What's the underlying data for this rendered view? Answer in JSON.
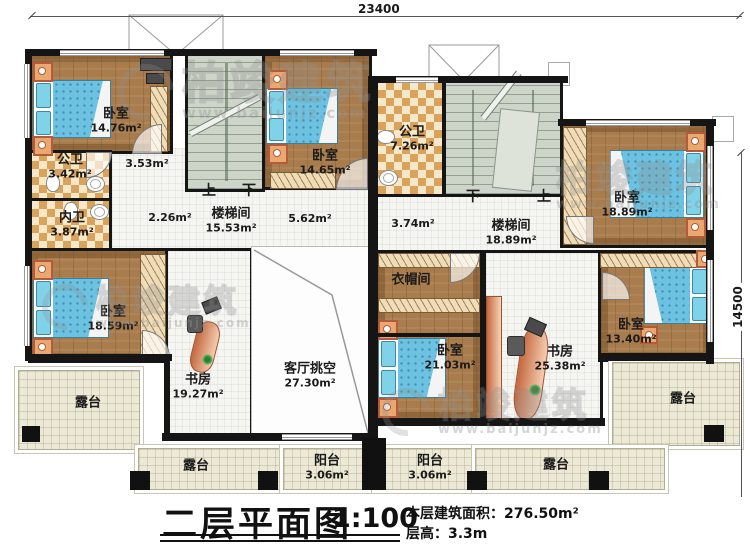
{
  "title": {
    "main": "二层平面图",
    "scale": "1:100",
    "area_label": "本层建筑面积：",
    "area_value": "276.50m²",
    "height_label": "层高：",
    "height_value": "3.3m"
  },
  "dimensions": {
    "width": "23400",
    "height": "14500"
  },
  "watermark": {
    "brand": "柏竣建筑",
    "url": "www.baijunjz.com"
  },
  "stairs": {
    "up": "上",
    "down": "下"
  },
  "colors": {
    "wall": "#151515",
    "wood_floor": "#a87c4c",
    "tile": "#d9a35c",
    "bed": "#6cc2e0",
    "stair": "#cdd5c9",
    "terrace": "#ece9d6"
  },
  "rooms": {
    "bedroom_tl": {
      "name": "卧室",
      "area": "14.76m²"
    },
    "bath_public_1": {
      "name": "公卫",
      "area": "3.42m²"
    },
    "bath_inner": {
      "name": "内卫",
      "area": "3.87m²"
    },
    "hall_353": {
      "area": "3.53m²"
    },
    "hall_226": {
      "area": "2.26m²"
    },
    "stair_left": {
      "name": "楼梯间",
      "area": "15.53m²"
    },
    "hall_562": {
      "area": "5.62m²"
    },
    "bedroom_tm": {
      "name": "卧室",
      "area": "14.65m²"
    },
    "bedroom_left": {
      "name": "卧室",
      "area": "18.59m²"
    },
    "study_left": {
      "name": "书房",
      "area": "19.27m²"
    },
    "living_void": {
      "name": "客厅挑空",
      "area": "27.30m²"
    },
    "bath_public_2": {
      "name": "公卫",
      "area": "7.26m²"
    },
    "hall_374": {
      "area": "3.74m²"
    },
    "stair_right": {
      "name": "楼梯间",
      "area": "18.89m²"
    },
    "bedroom_tr": {
      "name": "卧室",
      "area": "18.89m²"
    },
    "closet": {
      "name": "衣帽间"
    },
    "bedroom_mr": {
      "name": "卧室",
      "area": "21.03m²"
    },
    "study_right": {
      "name": "书房",
      "area": "25.38m²"
    },
    "bedroom_br": {
      "name": "卧室",
      "area": "13.40m²"
    },
    "terrace_left": {
      "name": "露台"
    },
    "terrace_right": {
      "name": "露台"
    },
    "terrace_bottom_left": {
      "name": "露台"
    },
    "balcony_left": {
      "name": "阳台",
      "area": "3.06m²"
    },
    "balcony_right": {
      "name": "阳台",
      "area": "3.06m²"
    },
    "terrace_bottom_right": {
      "name": "露台"
    }
  }
}
